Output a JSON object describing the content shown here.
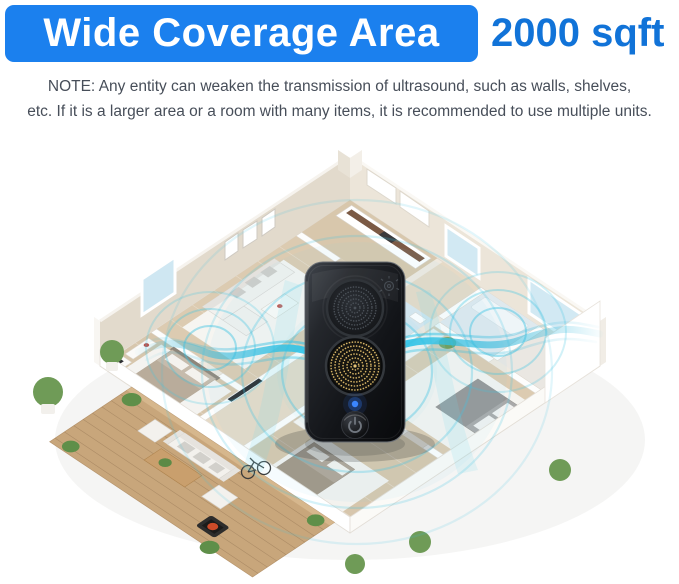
{
  "header": {
    "banner_label": "Wide Coverage Area",
    "coverage_value": "2000 sqft"
  },
  "note": {
    "lines": [
      "NOTE: Any entity can weaken the transmission of ultrasound, such as walls, shelves,",
      "etc. If it is a larger area or a room with many items, it is recommended to use multiple units."
    ]
  },
  "scene": {
    "subject": "ultrasonic pest repeller device centered over an isometric apartment floor plan with wooden deck, emitting ultrasonic waves through all rooms",
    "device_icons": [
      "speaker-grille-icon",
      "ultrasonic-emitter-icon",
      "led-indicator-icon",
      "power-icon",
      "light-sensor-icon"
    ]
  },
  "colors": {
    "banner_blue": "#1b80ee",
    "coverage_text_blue": "#1173d8",
    "note_text": "#474e59",
    "wave_cyan": "#3fc3e3",
    "device_body_black": "#15171a",
    "led_blue": "#3b86ff",
    "emitter_gold": "#d6b466",
    "floor_wood": "#dccbb1",
    "deck_wood": "#c8a67b",
    "wall_beige": "#e2dacc"
  }
}
